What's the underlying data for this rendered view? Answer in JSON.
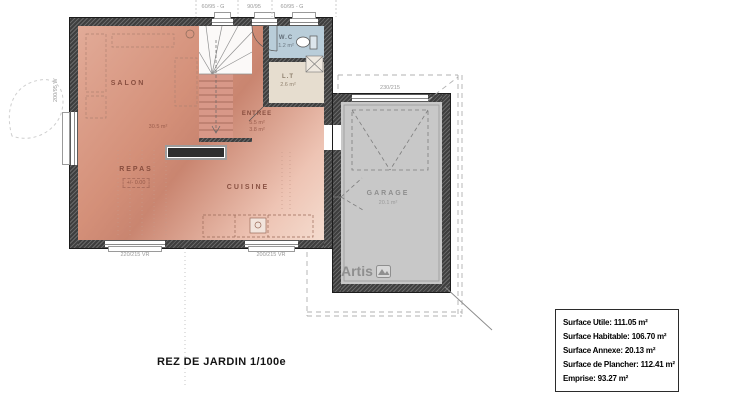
{
  "plan": {
    "title": "REZ DE JARDIN 1/100e",
    "rooms": {
      "salon": {
        "name": "SALON",
        "area": "30.5 m²"
      },
      "repas": {
        "name": "REPAS",
        "level": "+/- 0.00"
      },
      "cuisine": {
        "name": "CUISINE"
      },
      "entree": {
        "name": "ENTREE",
        "area1": "5.5 m²",
        "area2": "3.8 m²"
      },
      "wc": {
        "name": "W.C",
        "area": "1.2 m²"
      },
      "lt": {
        "name": "L.T",
        "area": "2.6 m²"
      },
      "garage": {
        "name": "GARAGE",
        "area": "20.1 m²"
      }
    },
    "dimensions": {
      "top_left": "60/95 - G",
      "top_mid": "90/95",
      "top_right": "60/95 - G",
      "left": "200/95 W",
      "bottom_left": "220/215 VR",
      "bottom_right": "200/215 VR",
      "garage_door": "230/215"
    },
    "colors": {
      "floor_main": "#d49079",
      "floor_wc": "#b9cdd9",
      "floor_lt": "#e6ddcf",
      "floor_garage": "#c8c8c8",
      "wall": "#3e3e3e"
    },
    "logo": "Artis"
  },
  "summary": {
    "rows": [
      {
        "label": "Surface Utile:",
        "value": "111.05 m²"
      },
      {
        "label": "Surface Habitable:",
        "value": "106.70 m²"
      },
      {
        "label": "Surface Annexe:",
        "value": "20.13 m²"
      },
      {
        "label": "Surface de Plancher:",
        "value": "112.41 m²"
      },
      {
        "label": "Emprise:",
        "value": "93.27 m²"
      }
    ]
  }
}
